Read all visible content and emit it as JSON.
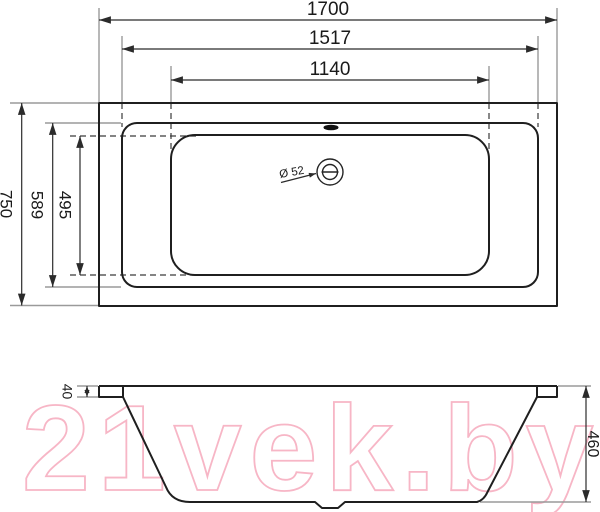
{
  "watermark": {
    "text": "21vek.by",
    "color": "#f7b6c6"
  },
  "top_view": {
    "dimensions": {
      "overall_length": "1700",
      "rim_length": "1517",
      "basin_length": "1140",
      "overall_width": "750",
      "rim_width": "589",
      "basin_width": "495",
      "drain_diameter": "Ø 52"
    }
  },
  "side_view": {
    "dimensions": {
      "rim_height": "40",
      "overall_height": "460"
    }
  },
  "colors": {
    "outline": "#1f1f1f",
    "dimension_lines": "#2b2b2b",
    "extension_lines": "#9a9a9a",
    "watermark": "#f7b6c6",
    "background": "#ffffff"
  }
}
